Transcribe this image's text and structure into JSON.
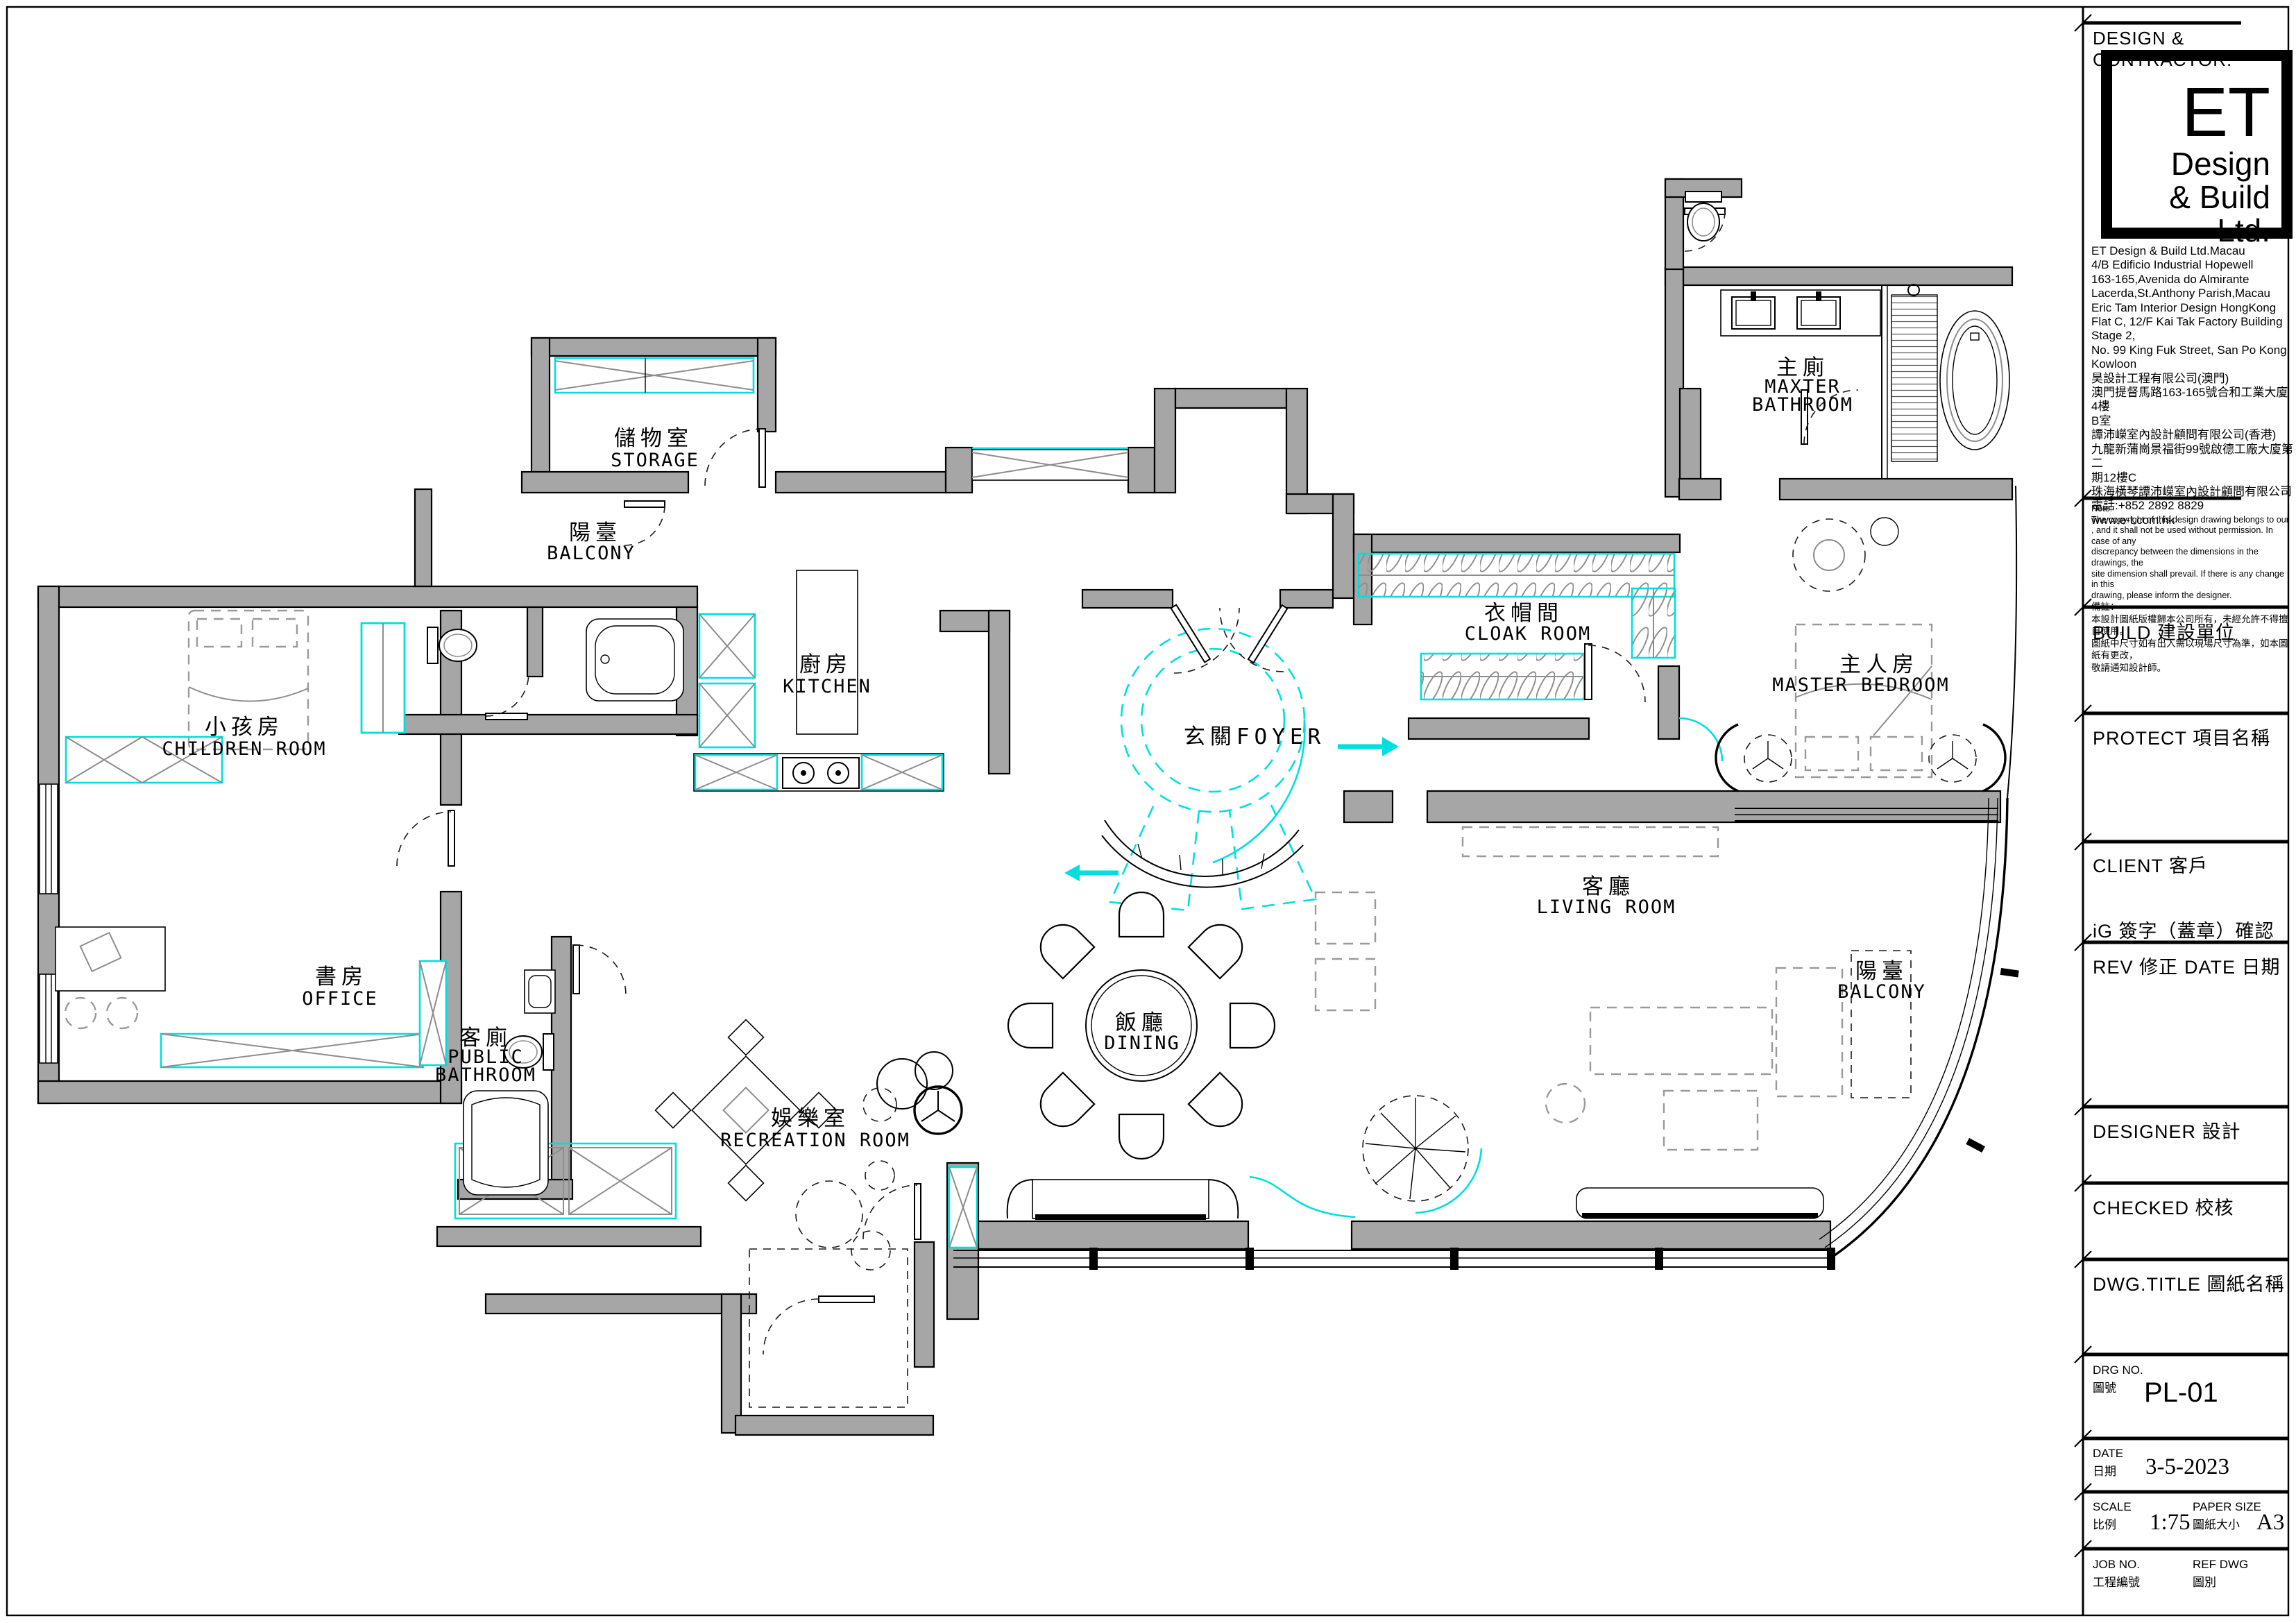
{
  "colors": {
    "wall_fill": "#a6a6a6",
    "accent_cyan": "#00dfdf",
    "line_black": "#000000",
    "furniture_gray": "#8d8d8d"
  },
  "rooms": {
    "storage": {
      "zh": "儲物室",
      "en": "STORAGE"
    },
    "balcony_left": {
      "zh": "陽臺",
      "en": "BALCONY"
    },
    "children": {
      "zh": "小孩房",
      "en": "CHILDREN ROOM"
    },
    "office": {
      "zh": "書房",
      "en": "OFFICE"
    },
    "public_bathroom": {
      "zh": "客廁",
      "en1": "PUBLIC",
      "en2": "BATHROOM"
    },
    "recreation": {
      "zh": "娛樂室",
      "en": "RECREATION ROOM"
    },
    "kitchen": {
      "zh": "廚房",
      "en": "KITCHEN"
    },
    "foyer": {
      "zh": "玄關FOYER"
    },
    "dining": {
      "zh": "飯廳",
      "en": "DINING"
    },
    "cloak": {
      "zh": "衣帽間",
      "en": "CLOAK ROOM"
    },
    "master_bathroom": {
      "zh": "主廁",
      "en1": "MAXTER",
      "en2": "BATHROOM"
    },
    "master_bedroom": {
      "zh": "主人房",
      "en": "MASTER BEDROOM"
    },
    "living": {
      "zh": "客廳",
      "en": "LIVING ROOM"
    },
    "balcony_right": {
      "zh": "陽臺",
      "en": "BALCONY"
    }
  },
  "title_block": {
    "header": "DESIGN & CONTRACTOR:",
    "logo": {
      "line1": "ET",
      "line2": "Design",
      "line3": "& Build Ltd."
    },
    "address_lines": [
      "ET Design & Build Ltd.Macau",
      "4/B Edificio Industrial Hopewell",
      "163-165,Avenida do Almirante",
      "Lacerda,St.Anthony Parish,Macau",
      "Eric Tam Interior Design HongKong",
      "Flat C, 12/F Kai Tak Factory Building",
      "Stage 2,",
      "No. 99 King Fuk Street, San Po Kong,",
      "Kowloon",
      "昊設計工程有限公司(澳門)",
      "澳門提督馬路163-165號合和工業大廈4樓",
      "B室",
      "譚沛嶸室內設計顧問有限公司(香港)",
      "九龍新蒲崗景福街99號啟德工廠大廈第二",
      "期12樓C",
      "珠海橫琴譚沛嶸室內設計顧問有限公司",
      "電話:+852 2892 8829",
      "www.e-t.com.hk"
    ],
    "note_lines_en": [
      "Note:",
      "The copyright of this design drawing belongs to our",
      ", and it shall not be used without permission. In case of any",
      "discrepancy between the dimensions in the drawings, the",
      "site dimension shall prevail. If there is any change in this",
      "drawing, please inform the designer."
    ],
    "note_lines_zh": [
      "備註：",
      "本設計圖紙版權歸本公司所有，未經允許不得擅自使用。",
      "圖紙中尺寸如有出入需以現場尺寸為準，如本圖紙有更改，",
      "敬請通知設計師。"
    ],
    "sections": [
      {
        "id": "build",
        "label": "BUILD 建設單位"
      },
      {
        "id": "protect",
        "label": "PROTECT 項目名稱"
      },
      {
        "id": "client",
        "label": "CLIENT 客戶"
      },
      {
        "id": "ig",
        "label": "iG 簽字（蓋章）確認"
      },
      {
        "id": "rev",
        "label": "REV 修正",
        "label2": "DATE 日期"
      },
      {
        "id": "designer",
        "label": "DESIGNER 設計"
      },
      {
        "id": "checked",
        "label": "CHECKED 校核"
      },
      {
        "id": "dwg_title",
        "label": "DWG.TITLE 圖紙名稱"
      }
    ],
    "drg_no": {
      "label": "DRG NO.",
      "label_zh": "圖號",
      "value": "PL-01"
    },
    "date": {
      "label": "DATE",
      "label_zh": "日期",
      "value": "3-5-2023"
    },
    "scale": {
      "label": "SCALE",
      "label_zh": "比例",
      "value": "1:75"
    },
    "paper_size": {
      "label": "PAPER SIZE",
      "label_zh": "圖紙大小",
      "value": "A3"
    },
    "job_no": {
      "label": "JOB NO.",
      "label_zh": "工程編號"
    },
    "ref_dwg": {
      "label": "REF DWG",
      "label_zh": "圖別"
    }
  }
}
